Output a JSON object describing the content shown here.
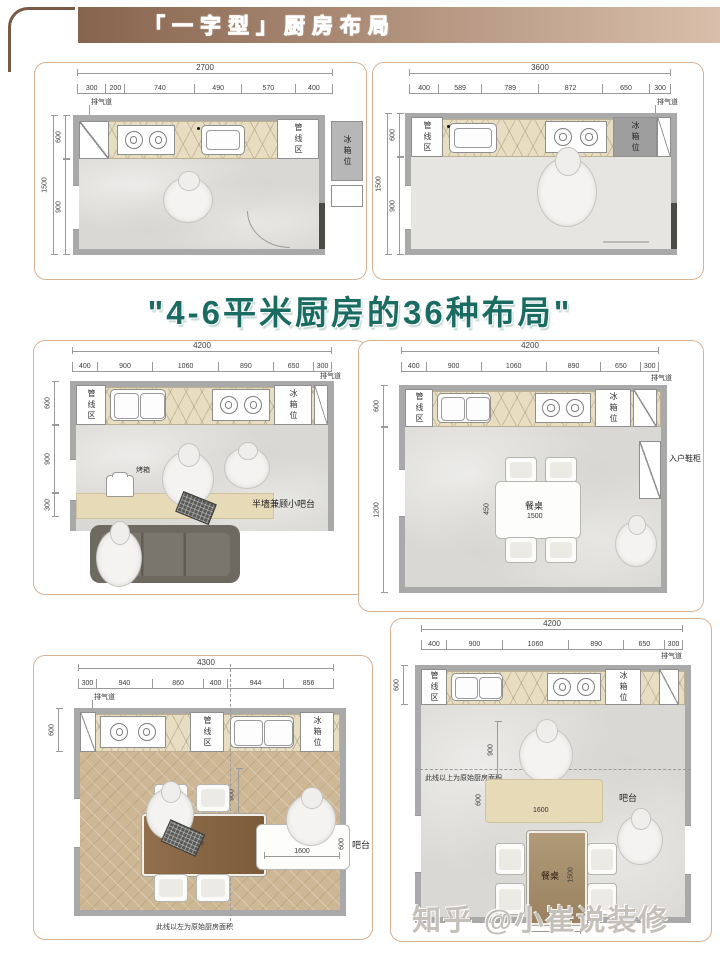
{
  "header": {
    "banner": "「一字型」厨房布局"
  },
  "title": "\"4-6平米厨房的36种布局\"",
  "watermark": "知乎 @小崔说装修",
  "colors": {
    "banner_from": "#87644e",
    "banner_to": "#d9bfab",
    "title": "#1a6b62",
    "card_border": "#d8b294",
    "wall": "#a9a9a9",
    "counter": "#e9ddc1"
  },
  "plans": {
    "p1": {
      "total": "2700",
      "segs": [
        "300",
        "200",
        "740",
        "490",
        "570",
        "400"
      ],
      "side_total": "1500",
      "side": [
        "600",
        "900"
      ],
      "exhaust": "排气道",
      "zones": [
        "烹饪区",
        "操作区",
        "洗涤区"
      ],
      "pipeline": "管线区",
      "fridge": "冰箱位"
    },
    "p2": {
      "total": "3600",
      "segs": [
        "400",
        "589",
        "789",
        "872",
        "650",
        "300"
      ],
      "side_total": "1500",
      "side": [
        "600",
        "900"
      ],
      "exhaust": "排气道",
      "zones": [
        "洗涤区",
        "操作区",
        "烹饪区"
      ],
      "pipeline": "管线区",
      "fridge": "冰箱位"
    },
    "p3": {
      "total": "4200",
      "segs": [
        "400",
        "900",
        "1060",
        "890",
        "650",
        "300"
      ],
      "side": [
        "600",
        "900",
        "300"
      ],
      "exhaust": "排气道",
      "zones": [
        "洗涤区",
        "操作区",
        "烹饪区"
      ],
      "pipeline": "管线区",
      "fridge": "冰箱位",
      "bar_note": "半墙兼顾小吧台",
      "oven": "烤箱"
    },
    "p4": {
      "total": "4200",
      "segs": [
        "400",
        "900",
        "1060",
        "890",
        "650",
        "300"
      ],
      "side": [
        "600",
        "1200"
      ],
      "exhaust": "排气道",
      "zones": [
        "洗涤区",
        "操作区",
        "烹饪区"
      ],
      "pipeline": "管线区",
      "fridge": "冰箱位",
      "shoe_cabinet": "入户鞋柜",
      "table": "餐桌",
      "table_w": "1500",
      "table_d": "450"
    },
    "p5": {
      "total": "4300",
      "segs": [
        "300",
        "940",
        "860",
        "400",
        "944",
        "856"
      ],
      "side": [
        "600"
      ],
      "exhaust": "排气道",
      "zones": [
        "烹饪区",
        "操作区",
        "洗涤区"
      ],
      "pipeline": "管线区",
      "fridge": "冰箱位",
      "table": "餐桌",
      "bar": "吧台",
      "bar_w": "1600",
      "bar_d": "600",
      "dim_900": "900",
      "caption": "此线以左为原始厨房面积"
    },
    "p6": {
      "total": "4200",
      "segs": [
        "400",
        "900",
        "1060",
        "890",
        "650",
        "300"
      ],
      "side": [
        "600"
      ],
      "exhaust": "排气道",
      "zones": [
        "洗涤区",
        "操作区",
        "烹饪区"
      ],
      "pipeline": "管线区",
      "fridge": "冰箱位",
      "bar": "吧台",
      "bar_w": "1600",
      "bar_d": "600",
      "dim_900": "900",
      "table": "餐桌",
      "table_l": "1500",
      "table_w": "800",
      "caption": "此线以上为原始厨房面积"
    }
  }
}
